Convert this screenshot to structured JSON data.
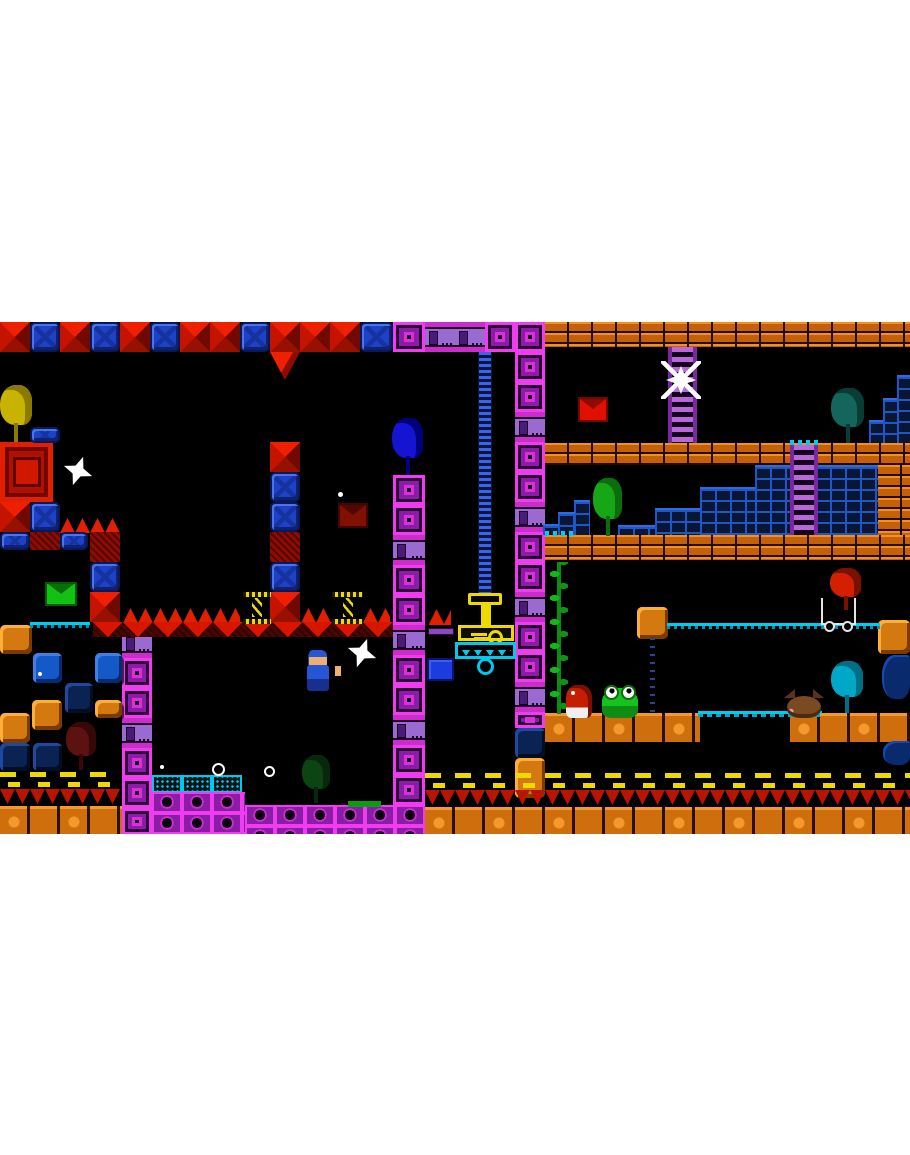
{
  "scene": {
    "app": "retro-pixel-platformer-screenshot",
    "page_background": "#ffffff",
    "field": {
      "x": 0,
      "y": 322,
      "w": 910,
      "h": 512,
      "bg": "#000000"
    }
  },
  "palette": {
    "magenta_block": "#ee3cee",
    "magenta_fill": "#8a1ca6",
    "machine_purple": "#9a6ad0",
    "blue_block": "#1d42c8",
    "red_spike": "#ee2000",
    "red_dark": "#700a00",
    "orange_brick": "#c66008",
    "orange_highlight": "#f0921e",
    "orange_cave": "#d4790f",
    "cave_blue": "#1558c8",
    "cave_navy": "#0b2352",
    "brick_steps_blue": "#1e56c8",
    "cyan": "#00c8ee",
    "yellow": "#eeda00",
    "vine_green": "#0c9c14",
    "envelope_red": "#e01000",
    "envelope_green": "#12c212",
    "envelope_darkred": "#801000",
    "player_blue": "#2656d6",
    "frog_green": "#17c21e",
    "white": "#ffffff"
  },
  "names": {
    "redd": "red-spike-block",
    "redh": "red-hatch-block",
    "redtri": "red-spike-triangle",
    "bluex": "blue-block",
    "msq": "magenta-block",
    "machine": "purple-machine-block",
    "mstrip": "magenta-block-strip",
    "bricko": "orange-brick-platform",
    "groundo": "orange-ground",
    "caveo": "orange-block",
    "caveb": "blue-cave-block",
    "caven": "navy-cave-block",
    "bsteps": "blue-brick-steps",
    "ladderp": "purple-ladder",
    "chainb": "blue-chain",
    "vine": "vine",
    "railc": "cyan-rail",
    "bridgec": "cyan-bridge",
    "dashc": "cyan-dashes",
    "track": "track-dots",
    "bandy": "yellow-dash-band",
    "bandr": "red-drip-band",
    "spikesu": "spike-row-up",
    "baser": "red-spike-base",
    "cyantile": "cyan-circuit-platform",
    "greenplat": "green-platform",
    "purplebar": "purple-ledge",
    "water": "water",
    "redbox": "red-gift-block",
    "spring": "yellow-spring",
    "presscap": "press-cap",
    "pressstem": "press-stem",
    "keybar": "key-bar",
    "grabber": "grabber-platform",
    "ring": "hook-ring",
    "bluebox": "blue-crate",
    "envred": "red-envelope",
    "envgreen": "green-envelope",
    "envdarkred": "darkred-envelope",
    "birdyellow": "yellow-bird",
    "birdblue": "blue-bird",
    "birdgreen": "green-bird",
    "birddarkteal": "darkteal-bird",
    "birdcyan": "cyan-bird",
    "birdred": "red-bird",
    "birddarkred": "darkred-bird",
    "birddarkgreen": "darkgreen-bird",
    "player": "player-character",
    "star": "white-star",
    "spider": "white-spider",
    "frog": "frog-enemy",
    "imp": "red-imp",
    "bat": "brown-bat",
    "cart": "white-cart",
    "sparklering": "sparkle-ring",
    "sparkledot": "sparkle-dot"
  },
  "tiles": [
    {
      "t": "redd",
      "x": 0,
      "y": 0,
      "w": 30,
      "h": 30
    },
    {
      "t": "bluex",
      "x": 30,
      "y": 0,
      "w": 30,
      "h": 30
    },
    {
      "t": "redd",
      "x": 60,
      "y": 0,
      "w": 30,
      "h": 30
    },
    {
      "t": "bluex",
      "x": 90,
      "y": 0,
      "w": 30,
      "h": 30
    },
    {
      "t": "redd",
      "x": 120,
      "y": 0,
      "w": 30,
      "h": 30
    },
    {
      "t": "bluex",
      "x": 150,
      "y": 0,
      "w": 30,
      "h": 30
    },
    {
      "t": "redd",
      "x": 180,
      "y": 0,
      "w": 30,
      "h": 30
    },
    {
      "t": "redd",
      "x": 210,
      "y": 0,
      "w": 30,
      "h": 30
    },
    {
      "t": "bluex",
      "x": 240,
      "y": 0,
      "w": 30,
      "h": 30
    },
    {
      "t": "redd",
      "x": 270,
      "y": 0,
      "w": 30,
      "h": 30
    },
    {
      "t": "redd",
      "x": 300,
      "y": 0,
      "w": 30,
      "h": 30
    },
    {
      "t": "redd",
      "x": 330,
      "y": 0,
      "w": 30,
      "h": 30
    },
    {
      "t": "bluex",
      "x": 360,
      "y": 0,
      "w": 33,
      "h": 30
    },
    {
      "t": "redtri",
      "x": 270,
      "y": 30,
      "w": 30,
      "h": 28
    },
    {
      "t": "msq",
      "x": 393,
      "y": 0,
      "w": 32,
      "h": 30
    },
    {
      "t": "machine",
      "x": 425,
      "y": 0,
      "w": 30,
      "h": 30
    },
    {
      "t": "machine",
      "x": 455,
      "y": 0,
      "w": 30,
      "h": 30
    },
    {
      "t": "msq",
      "x": 485,
      "y": 0,
      "w": 30,
      "h": 30
    },
    {
      "t": "msq",
      "x": 515,
      "y": 0,
      "w": 30,
      "h": 30
    },
    {
      "t": "msq",
      "x": 515,
      "y": 30,
      "w": 30,
      "h": 30
    },
    {
      "t": "msq",
      "x": 515,
      "y": 60,
      "w": 30,
      "h": 30
    },
    {
      "t": "machine",
      "x": 515,
      "y": 90,
      "w": 30,
      "h": 30
    },
    {
      "t": "msq",
      "x": 515,
      "y": 120,
      "w": 30,
      "h": 30
    },
    {
      "t": "msq",
      "x": 515,
      "y": 150,
      "w": 30,
      "h": 30
    },
    {
      "t": "machine",
      "x": 515,
      "y": 180,
      "w": 30,
      "h": 30
    },
    {
      "t": "msq",
      "x": 515,
      "y": 210,
      "w": 30,
      "h": 30
    },
    {
      "t": "msq",
      "x": 515,
      "y": 240,
      "w": 30,
      "h": 30
    },
    {
      "t": "machine",
      "x": 515,
      "y": 270,
      "w": 30,
      "h": 30
    },
    {
      "t": "msq",
      "x": 515,
      "y": 300,
      "w": 30,
      "h": 30
    },
    {
      "t": "msq",
      "x": 515,
      "y": 330,
      "w": 30,
      "h": 30
    },
    {
      "t": "machine",
      "x": 515,
      "y": 360,
      "w": 30,
      "h": 30
    },
    {
      "t": "msq",
      "x": 515,
      "y": 390,
      "w": 30,
      "h": 16
    },
    {
      "t": "caven",
      "x": 515,
      "y": 406,
      "w": 30,
      "h": 30
    },
    {
      "t": "caveo",
      "x": 515,
      "y": 436,
      "w": 30,
      "h": 40
    },
    {
      "t": "msq",
      "x": 393,
      "y": 153,
      "w": 32,
      "h": 30
    },
    {
      "t": "msq",
      "x": 393,
      "y": 183,
      "w": 32,
      "h": 30
    },
    {
      "t": "machine",
      "x": 393,
      "y": 213,
      "w": 32,
      "h": 30
    },
    {
      "t": "msq",
      "x": 393,
      "y": 243,
      "w": 32,
      "h": 30
    },
    {
      "t": "msq",
      "x": 393,
      "y": 273,
      "w": 32,
      "h": 30
    },
    {
      "t": "machine",
      "x": 393,
      "y": 303,
      "w": 32,
      "h": 30
    },
    {
      "t": "msq",
      "x": 393,
      "y": 333,
      "w": 32,
      "h": 30
    },
    {
      "t": "msq",
      "x": 393,
      "y": 363,
      "w": 32,
      "h": 30
    },
    {
      "t": "machine",
      "x": 393,
      "y": 393,
      "w": 32,
      "h": 30
    },
    {
      "t": "msq",
      "x": 393,
      "y": 423,
      "w": 32,
      "h": 30
    },
    {
      "t": "msq",
      "x": 393,
      "y": 453,
      "w": 32,
      "h": 30
    },
    {
      "t": "machine",
      "x": 393,
      "y": 483,
      "w": 32,
      "h": 30
    },
    {
      "t": "machine",
      "x": 122,
      "y": 306,
      "w": 30,
      "h": 30
    },
    {
      "t": "msq",
      "x": 122,
      "y": 336,
      "w": 30,
      "h": 30
    },
    {
      "t": "msq",
      "x": 122,
      "y": 366,
      "w": 30,
      "h": 30
    },
    {
      "t": "machine",
      "x": 122,
      "y": 396,
      "w": 30,
      "h": 30
    },
    {
      "t": "msq",
      "x": 122,
      "y": 426,
      "w": 30,
      "h": 30
    },
    {
      "t": "msq",
      "x": 122,
      "y": 456,
      "w": 30,
      "h": 30
    },
    {
      "t": "msq",
      "x": 122,
      "y": 486,
      "w": 30,
      "h": 27
    },
    {
      "t": "bricko",
      "x": 545,
      "y": 0,
      "w": 365,
      "h": 25
    },
    {
      "t": "bricko",
      "x": 545,
      "y": 121,
      "w": 365,
      "h": 22
    },
    {
      "t": "bricko",
      "x": 545,
      "y": 213,
      "w": 365,
      "h": 25
    },
    {
      "t": "bricko",
      "x": 878,
      "y": 143,
      "w": 32,
      "h": 70
    },
    {
      "t": "caveo",
      "x": 878,
      "y": 298,
      "w": 32,
      "h": 34
    },
    {
      "t": "groundo",
      "x": 545,
      "y": 391,
      "w": 155,
      "h": 29
    },
    {
      "t": "groundo",
      "x": 790,
      "y": 391,
      "w": 120,
      "h": 29
    },
    {
      "t": "caveo",
      "x": 0,
      "y": 303,
      "w": 32,
      "h": 29
    },
    {
      "t": "caveb",
      "x": 33,
      "y": 331,
      "w": 29,
      "h": 30
    },
    {
      "t": "caveb",
      "x": 95,
      "y": 331,
      "w": 27,
      "h": 30
    },
    {
      "t": "caven",
      "x": 65,
      "y": 361,
      "w": 28,
      "h": 30
    },
    {
      "t": "caveo",
      "x": 32,
      "y": 378,
      "w": 30,
      "h": 30
    },
    {
      "t": "caveo",
      "x": 0,
      "y": 391,
      "w": 30,
      "h": 30
    },
    {
      "t": "caven",
      "x": 0,
      "y": 421,
      "w": 30,
      "h": 28
    },
    {
      "t": "caven",
      "x": 33,
      "y": 421,
      "w": 29,
      "h": 28
    },
    {
      "t": "caveo",
      "x": 95,
      "y": 378,
      "w": 27,
      "h": 18
    },
    {
      "t": "bsteps",
      "x": 897,
      "y": 53,
      "w": 13,
      "h": 68
    },
    {
      "t": "bsteps",
      "x": 883,
      "y": 76,
      "w": 14,
      "h": 45
    },
    {
      "t": "bsteps",
      "x": 869,
      "y": 98,
      "w": 14,
      "h": 23
    },
    {
      "t": "bsteps",
      "x": 755,
      "y": 143,
      "w": 123,
      "h": 70
    },
    {
      "t": "bsteps",
      "x": 700,
      "y": 165,
      "w": 55,
      "h": 48
    },
    {
      "t": "bsteps",
      "x": 655,
      "y": 186,
      "w": 45,
      "h": 27
    },
    {
      "t": "bsteps",
      "x": 618,
      "y": 203,
      "w": 37,
      "h": 10
    },
    {
      "t": "bsteps",
      "x": 574,
      "y": 178,
      "w": 16,
      "h": 35
    },
    {
      "t": "bsteps",
      "x": 558,
      "y": 190,
      "w": 17,
      "h": 23
    },
    {
      "t": "bsteps",
      "x": 543,
      "y": 202,
      "w": 16,
      "h": 11
    },
    {
      "t": "ladderp",
      "x": 668,
      "y": 25,
      "w": 29,
      "h": 96
    },
    {
      "t": "dashc",
      "x": 790,
      "y": 118,
      "w": 28,
      "h": 5
    },
    {
      "t": "ladderp",
      "x": 790,
      "y": 123,
      "w": 28,
      "h": 90
    },
    {
      "t": "chainb",
      "x": 478,
      "y": 30,
      "w": 14,
      "h": 243
    },
    {
      "t": "dashc",
      "x": 545,
      "y": 209,
      "w": 32,
      "h": 5
    },
    {
      "t": "redbox",
      "x": 0,
      "y": 120,
      "w": 53,
      "h": 60
    },
    {
      "t": "bluex",
      "x": 30,
      "y": 105,
      "w": 30,
      "h": 16
    },
    {
      "t": "redd",
      "x": 0,
      "y": 180,
      "w": 30,
      "h": 30
    },
    {
      "t": "bluex",
      "x": 30,
      "y": 180,
      "w": 30,
      "h": 30
    },
    {
      "t": "spikesu",
      "x": 60,
      "y": 196,
      "w": 60,
      "h": 15
    },
    {
      "t": "bluex",
      "x": 0,
      "y": 210,
      "w": 30,
      "h": 18
    },
    {
      "t": "redh",
      "x": 30,
      "y": 210,
      "w": 30,
      "h": 18
    },
    {
      "t": "bluex",
      "x": 60,
      "y": 210,
      "w": 28,
      "h": 18
    },
    {
      "t": "redh",
      "x": 90,
      "y": 210,
      "w": 30,
      "h": 30
    },
    {
      "t": "bluex",
      "x": 90,
      "y": 240,
      "w": 30,
      "h": 30
    },
    {
      "t": "redd",
      "x": 90,
      "y": 270,
      "w": 30,
      "h": 30
    },
    {
      "t": "redd",
      "x": 270,
      "y": 120,
      "w": 30,
      "h": 30
    },
    {
      "t": "bluex",
      "x": 270,
      "y": 150,
      "w": 30,
      "h": 30
    },
    {
      "t": "bluex",
      "x": 270,
      "y": 180,
      "w": 30,
      "h": 30
    },
    {
      "t": "redh",
      "x": 270,
      "y": 210,
      "w": 30,
      "h": 30
    },
    {
      "t": "bluex",
      "x": 270,
      "y": 240,
      "w": 30,
      "h": 30
    },
    {
      "t": "redd",
      "x": 270,
      "y": 270,
      "w": 30,
      "h": 30
    },
    {
      "t": "spikesu",
      "x": 123,
      "y": 286,
      "w": 117,
      "h": 15
    },
    {
      "t": "spikesu",
      "x": 301,
      "y": 286,
      "w": 30,
      "h": 15
    },
    {
      "t": "spikesu",
      "x": 363,
      "y": 286,
      "w": 27,
      "h": 15
    },
    {
      "t": "baser",
      "x": 93,
      "y": 300,
      "w": 300,
      "h": 15
    },
    {
      "t": "railc",
      "x": 30,
      "y": 300,
      "w": 60,
      "h": 6
    },
    {
      "t": "spikesu",
      "x": 429,
      "y": 287,
      "w": 22,
      "h": 16
    },
    {
      "t": "purplebar",
      "x": 428,
      "y": 306,
      "w": 26,
      "h": 7
    },
    {
      "t": "vine",
      "x": 548,
      "y": 240,
      "w": 22,
      "h": 152
    },
    {
      "t": "caveo",
      "x": 637,
      "y": 285,
      "w": 31,
      "h": 32
    },
    {
      "t": "railc",
      "x": 667,
      "y": 301,
      "w": 213,
      "h": 6
    },
    {
      "t": "track",
      "x": 650,
      "y": 316,
      "w": 5,
      "h": 74
    },
    {
      "t": "bridgec",
      "x": 698,
      "y": 389,
      "w": 124,
      "h": 6
    },
    {
      "t": "water",
      "x": 882,
      "y": 333,
      "w": 28,
      "h": 44
    },
    {
      "t": "water",
      "x": 883,
      "y": 419,
      "w": 27,
      "h": 24
    },
    {
      "t": "bandy",
      "x": 0,
      "y": 450,
      "w": 120,
      "h": 17
    },
    {
      "t": "bandr",
      "x": 0,
      "y": 467,
      "w": 120,
      "h": 17
    },
    {
      "t": "groundo",
      "x": 0,
      "y": 484,
      "w": 122,
      "h": 28
    },
    {
      "t": "bandy",
      "x": 425,
      "y": 451,
      "w": 485,
      "h": 17
    },
    {
      "t": "bandr",
      "x": 425,
      "y": 468,
      "w": 485,
      "h": 17
    },
    {
      "t": "groundo",
      "x": 425,
      "y": 485,
      "w": 485,
      "h": 27
    },
    {
      "t": "cyantile",
      "x": 152,
      "y": 453,
      "w": 30,
      "h": 18
    },
    {
      "t": "cyantile",
      "x": 182,
      "y": 453,
      "w": 30,
      "h": 18
    },
    {
      "t": "cyantile",
      "x": 212,
      "y": 453,
      "w": 30,
      "h": 18
    },
    {
      "t": "mstrip",
      "x": 152,
      "y": 470,
      "w": 93,
      "h": 42
    },
    {
      "t": "mstrip",
      "x": 245,
      "y": 483,
      "w": 180,
      "h": 29
    },
    {
      "t": "greenplat",
      "x": 348,
      "y": 479,
      "w": 33,
      "h": 6
    }
  ],
  "sprites": [
    {
      "t": "presscap",
      "x": 468,
      "y": 271,
      "w": 34,
      "h": 12
    },
    {
      "t": "pressstem",
      "x": 481,
      "y": 283,
      "w": 10,
      "h": 21
    },
    {
      "t": "keybar",
      "x": 458,
      "y": 303,
      "w": 56,
      "h": 16
    },
    {
      "t": "grabber",
      "x": 455,
      "y": 320,
      "w": 61,
      "h": 17
    },
    {
      "t": "ring",
      "x": 477,
      "y": 336,
      "w": 17,
      "h": 17
    },
    {
      "t": "bluebox",
      "x": 427,
      "y": 336,
      "w": 27,
      "h": 23
    },
    {
      "t": "spring",
      "x": 243,
      "y": 270,
      "w": 28,
      "h": 32
    },
    {
      "t": "spring",
      "x": 332,
      "y": 270,
      "w": 31,
      "h": 32
    },
    {
      "t": "envred",
      "x": 578,
      "y": 75,
      "w": 30,
      "h": 25
    },
    {
      "t": "envgreen",
      "x": 45,
      "y": 260,
      "w": 32,
      "h": 24
    },
    {
      "t": "envdarkred",
      "x": 338,
      "y": 181,
      "w": 30,
      "h": 25
    },
    {
      "t": "birdyellow",
      "x": 0,
      "y": 63,
      "w": 36,
      "h": 57
    },
    {
      "t": "birdblue",
      "x": 392,
      "y": 96,
      "w": 34,
      "h": 57
    },
    {
      "t": "birdgreen",
      "x": 593,
      "y": 156,
      "w": 32,
      "h": 58
    },
    {
      "t": "birddarkteal",
      "x": 831,
      "y": 66,
      "w": 37,
      "h": 55
    },
    {
      "t": "birdcyan",
      "x": 831,
      "y": 339,
      "w": 36,
      "h": 52
    },
    {
      "t": "birddarkred",
      "x": 66,
      "y": 400,
      "w": 33,
      "h": 48
    },
    {
      "t": "birddarkgreen",
      "x": 302,
      "y": 433,
      "w": 31,
      "h": 48
    },
    {
      "t": "birdred",
      "x": 830,
      "y": 246,
      "w": 34,
      "h": 42
    },
    {
      "t": "cart",
      "x": 821,
      "y": 276,
      "w": 35,
      "h": 27
    },
    {
      "t": "player",
      "x": 305,
      "y": 328,
      "w": 28,
      "h": 42
    },
    {
      "t": "star",
      "x": 347,
      "y": 316,
      "w": 30,
      "h": 30
    },
    {
      "t": "star",
      "x": 63,
      "y": 134,
      "w": 30,
      "h": 30
    },
    {
      "t": "spider",
      "x": 662,
      "y": 40,
      "w": 38,
      "h": 36
    },
    {
      "t": "frog",
      "x": 602,
      "y": 366,
      "w": 36,
      "h": 30
    },
    {
      "t": "imp",
      "x": 566,
      "y": 363,
      "w": 26,
      "h": 33
    },
    {
      "t": "bat",
      "x": 787,
      "y": 374,
      "w": 34,
      "h": 22
    },
    {
      "t": "sparklering",
      "x": 212,
      "y": 441,
      "w": 13,
      "h": 13
    },
    {
      "t": "sparklering",
      "x": 264,
      "y": 444,
      "w": 11,
      "h": 11
    },
    {
      "t": "sparkledot",
      "x": 338,
      "y": 170,
      "w": 5,
      "h": 5
    },
    {
      "t": "sparkledot",
      "x": 160,
      "y": 443,
      "w": 4,
      "h": 4
    },
    {
      "t": "sparkledot",
      "x": 38,
      "y": 350,
      "w": 4,
      "h": 4
    }
  ]
}
